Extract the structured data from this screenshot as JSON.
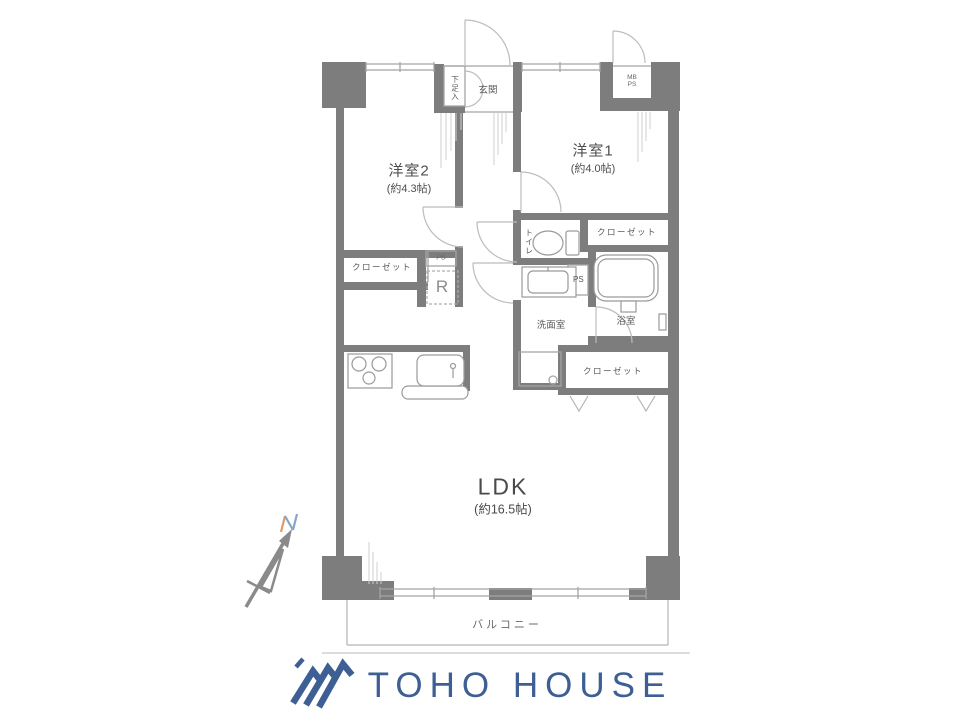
{
  "floorplan": {
    "rooms": {
      "bedroom2": {
        "name": "洋室2",
        "size": "(約4.3帖)"
      },
      "bedroom1": {
        "name": "洋室1",
        "size": "(約4.0帖)"
      },
      "ldk": {
        "name": "LDK",
        "size": "(約16.5帖)"
      },
      "entrance": {
        "name": "玄関"
      },
      "shoe_storage": {
        "name": "下足入"
      },
      "toilet": {
        "name": "トイレ"
      },
      "washroom": {
        "name": "洗面室"
      },
      "bathroom": {
        "name": "浴室"
      },
      "balcony": {
        "name": "バルコニー"
      }
    },
    "storage": {
      "closet_bedroom2": "クローゼット",
      "closet_bedroom1": "クローゼット",
      "closet_ldk": "クローゼット"
    },
    "utility": {
      "meter_box_line1": "MB",
      "meter_box_line2": "PS",
      "pipe_space_small": "PS",
      "pipe_space_bath": "PS",
      "refrigerator_space": "R"
    },
    "compass": {
      "north": "N"
    }
  },
  "footer": {
    "brand": "TOHO HOUSE"
  },
  "colors": {
    "wall": "#7d7d7d",
    "thin_line": "#a5a5a5",
    "text": "#555555",
    "brand_blue": "#3d5f94",
    "compass_orange": "#e09a6a",
    "compass_blue": "#86a5cc"
  }
}
